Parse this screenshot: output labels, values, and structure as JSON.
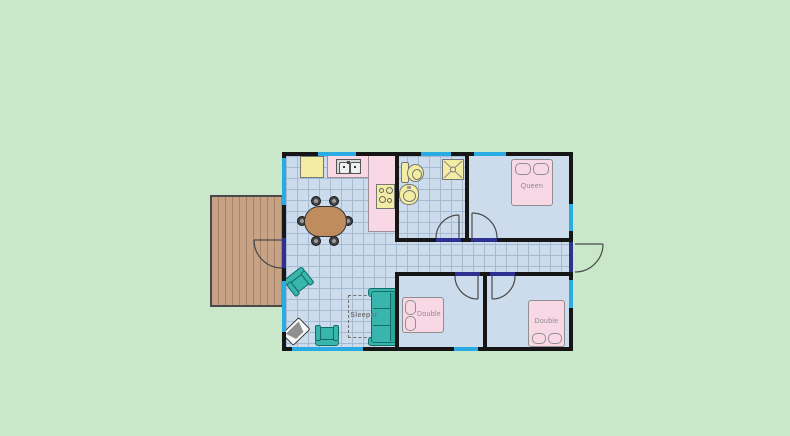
{
  "floorplan": {
    "labels": {
      "queen_bed": "Queen",
      "double_bed_left": "Double",
      "double_bed_right": "Double",
      "sleeper_sofa": "Sleeper"
    },
    "colors": {
      "background": "#c9e8c9",
      "floor": "#cddcec",
      "grid_line": "#a6bad2",
      "wall": "#161616",
      "window": "#2aabe3",
      "door_sill": "#2e3192",
      "kitchen_counter": "#f9d8e5",
      "bed": "#f9d8e5",
      "fixture_yellow": "#f2eda3",
      "furniture_teal": "#38b6ae",
      "table_wood": "#bf8d5d",
      "deck_wood": "#c8a284",
      "label_text": "#8a8a8a"
    }
  }
}
